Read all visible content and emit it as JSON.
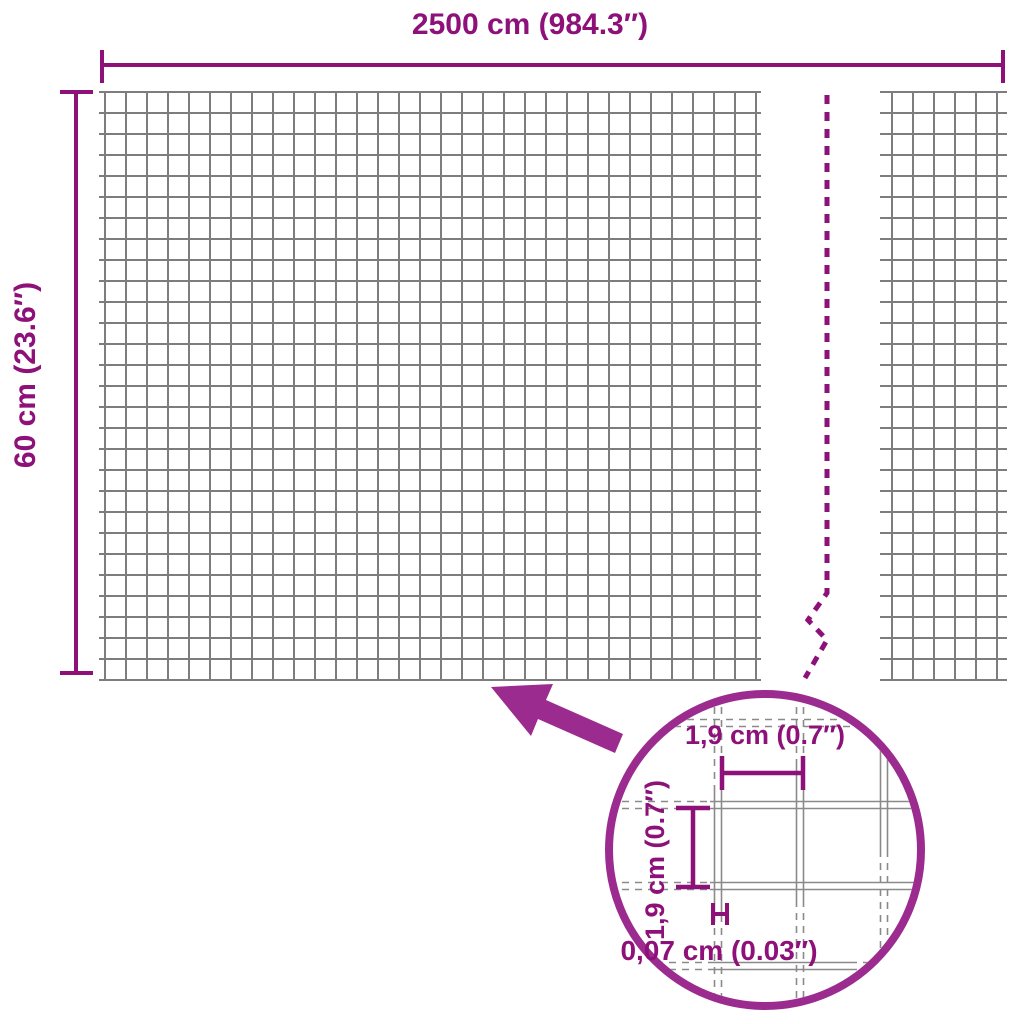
{
  "diagram": {
    "width_label": "2500 cm (984.3″)",
    "height_label": "60 cm (23.6″)",
    "detail_labels": {
      "mesh_width": "1,9 cm (0.7″)",
      "mesh_height": "1,9 cm (0.7″)",
      "wire_thickness": "0,07 cm (0.03″)"
    },
    "colors": {
      "dimension_magenta": "#8D1179",
      "accent_magenta": "#9C2B8F",
      "mesh_gray": "#7D7D7D"
    }
  }
}
